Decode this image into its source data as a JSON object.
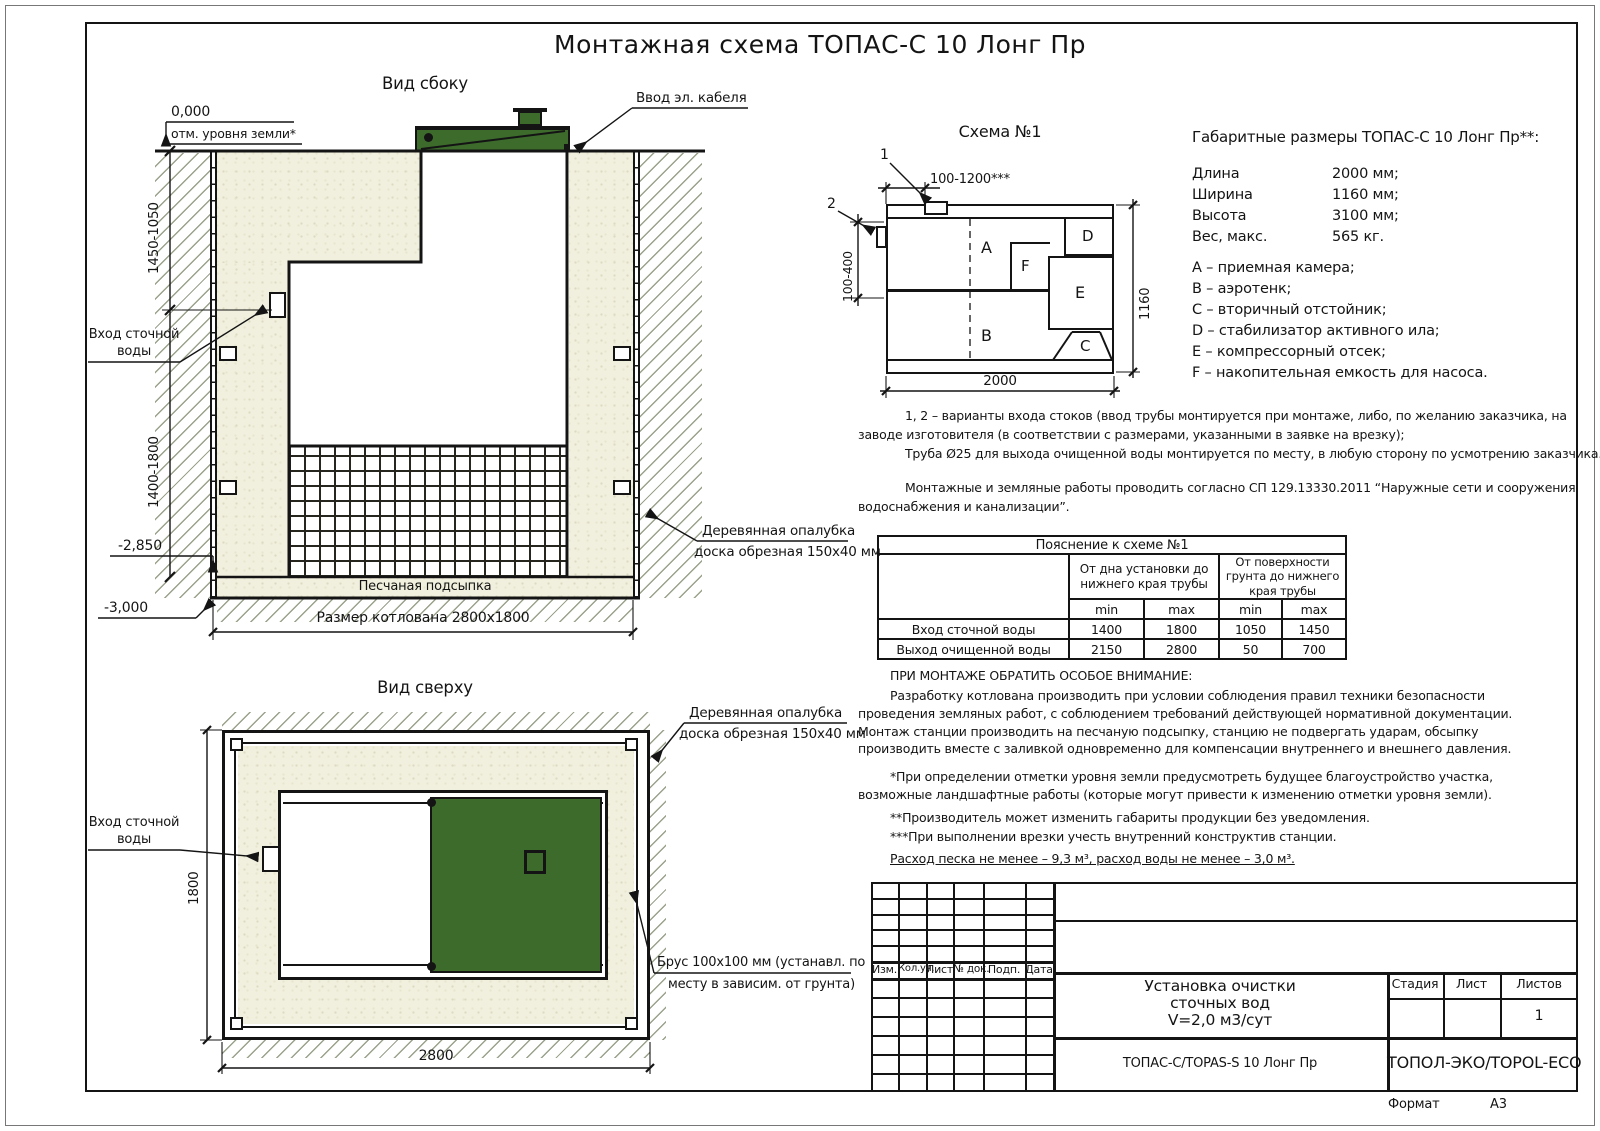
{
  "colors": {
    "green": "#3d6b2c",
    "sand": "#f1f0de",
    "line": "#141414",
    "hatch": "#9aa28c"
  },
  "page": {
    "title": "Монтажная схема ТОПАС-С 10 Лонг Пр",
    "format_label": "Формат",
    "format_value": "А3"
  },
  "side_view": {
    "title": "Вид сбоку",
    "cable_label": "Ввод эл. кабеля",
    "zero_mark": "0,000",
    "ground_mark": "отм. уровня земли*",
    "dim_upper": "1450-1050",
    "dim_lower": "1400-1800",
    "inlet_line1": "Вход сточной",
    "inlet_line2": "воды",
    "elev1": "-2,850",
    "elev2": "-3,000",
    "bedding_label": "Песчаная подсыпка",
    "pit_dim": "Размер котлована 2800х1800",
    "formwork_line1": "Деревянная опалубка",
    "formwork_line2": "доска обрезная 150х40 мм"
  },
  "top_view": {
    "title": "Вид сверху",
    "inlet_line1": "Вход сточной",
    "inlet_line2": "воды",
    "dim_height": "1800",
    "dim_width": "2800",
    "formwork_line1": "Деревянная опалубка",
    "formwork_line2": "доска обрезная 150х40 мм",
    "beam_line1": "Брус 100х100 мм (устанавл. по",
    "beam_line2": "месту в зависим. от грунта)"
  },
  "schema": {
    "title": "Схема №1",
    "marker1": "1",
    "marker2": "2",
    "dim_top": "100-1200***",
    "dim_left": "100-400",
    "dim_width": "2000",
    "dim_height": "1160",
    "comp_a": "A",
    "comp_b": "B",
    "comp_c": "C",
    "comp_d": "D",
    "comp_e": "E",
    "comp_f": "F"
  },
  "specs": {
    "heading": "Габаритные размеры ТОПАС-С 10 Лонг Пр**:",
    "rows": [
      {
        "label": "Длина",
        "value": "2000 мм;"
      },
      {
        "label": "Ширина",
        "value": "1160 мм;"
      },
      {
        "label": "Высота",
        "value": "3100 мм;"
      },
      {
        "label": "Вес, макс.",
        "value": "565 кг."
      }
    ],
    "legend": [
      "A – приемная камера;",
      "B – аэротенк;",
      "C – вторичный отстойник;",
      "D – стабилизатор активного ила;",
      "E – компрессорный отсек;",
      "F – накопительная емкость для насоса."
    ]
  },
  "notes": {
    "line1": "1, 2 – варианты входа  стоков (ввод трубы монтируется при монтаже, либо, по желанию заказчика, на",
    "line2": "заводе изготовителя (в соответствии с размерами, указанными в заявке на врезку);",
    "line3": "Труба Ø25 для выхода очищенной воды монтируется по месту, в любую сторону по усмотрению заказчика.",
    "line4": "Монтажные и земляные работы проводить согласно СП 129.13330.2011 “Наружные сети и сооружения",
    "line5": "водоснабжения и канализации”."
  },
  "table": {
    "title": "Пояснение к схеме №1",
    "col_group1": "От дна установки до нижнего края трубы",
    "col_group2": "От поверхности грунта до нижнего края трубы",
    "min_label": "min",
    "max_label": "max",
    "rows": [
      {
        "label": "Вход сточной воды",
        "v1": "1400",
        "v2": "1800",
        "v3": "1050",
        "v4": "1450"
      },
      {
        "label": "Выход очищенной воды",
        "v1": "2150",
        "v2": "2800",
        "v3": "50",
        "v4": "700"
      }
    ]
  },
  "warning": {
    "heading": "ПРИ МОНТАЖЕ ОБРАТИТЬ ОСОБОЕ ВНИМАНИЕ:",
    "body": "Разработку котлована производить при условии соблюдения правил техники безопасности проведения земляных работ, с соблюдением требований действующей нормативной документации. Монтаж станции производить на песчаную подсыпку, станцию не подвергать ударам, обсыпку производить вместе с заливкой одновременно для компенсации внутреннего и внешнего давления.",
    "note1": "*При определении отметки уровня земли предусмотреть будущее благоустройство участка, возможные ландшафтные работы (которые могут привести к изменению отметки уровня земли).",
    "note2": "**Производитель может изменить габариты продукции без уведомления.",
    "note3": "***При выполнении врезки учесть внутренний конструктив станции.",
    "consumption": "Расход песка не менее – 9,3 м³, расход воды не менее – 3,0 м³."
  },
  "title_block": {
    "rev_headers": [
      "Изм.",
      "Кол.уч.",
      "Лист",
      "№ док.",
      "Подп.",
      "Дата"
    ],
    "doc_line1": "Установка очистки",
    "doc_line2": "сточных вод",
    "doc_line3": "V=2,0 м3/сут",
    "stage_label": "Стадия",
    "sheet_label": "Лист",
    "sheets_label": "Листов",
    "sheets_value": "1",
    "model": "ТОПАС-С/TOPAS-S 10 Лонг Пр",
    "company": "ТОПОЛ-ЭКО/TOPOL-ECO"
  }
}
